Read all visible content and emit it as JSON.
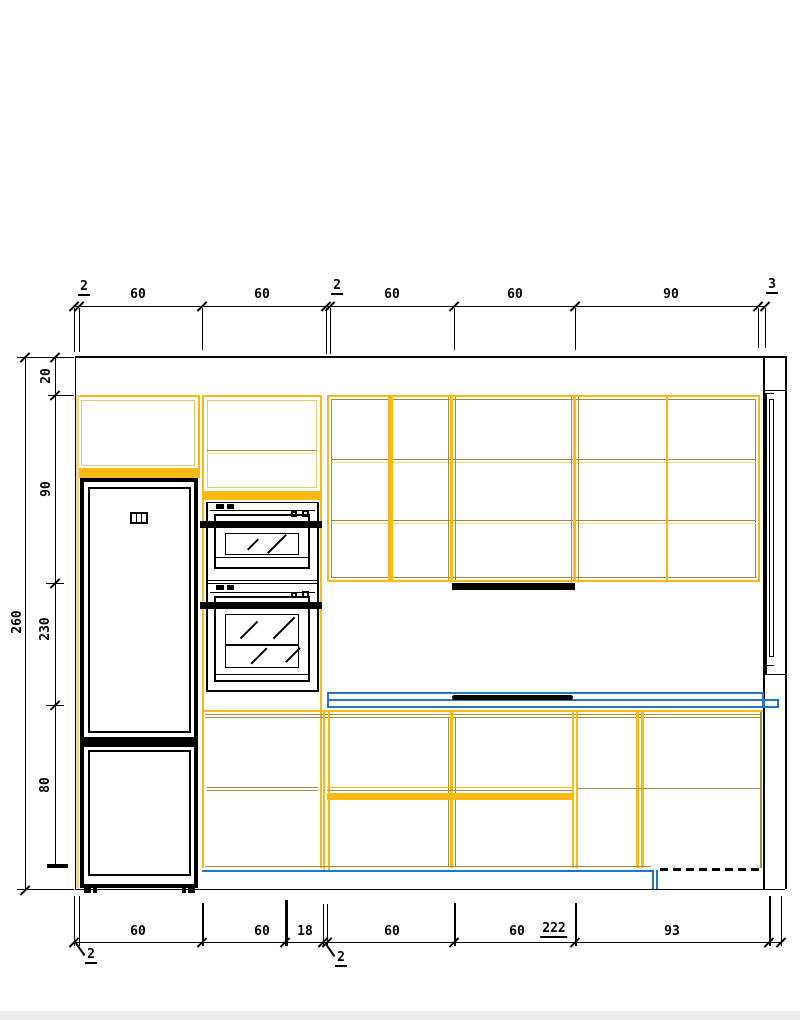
{
  "dims": {
    "top": [
      "2",
      "60",
      "60",
      "2",
      "60",
      "60",
      "90",
      "3"
    ],
    "left": [
      "20",
      "90",
      "230",
      "80"
    ],
    "left_overall": "260",
    "bottom": [
      "60",
      "60",
      "18",
      "60",
      "60",
      "222",
      "93"
    ],
    "leaders": [
      "2",
      "2"
    ]
  },
  "colors": {
    "cabinet_accent": "#FDB913",
    "cabinet_frame": "#A08C3C",
    "countertop": "#2176C7",
    "appliance": "#000000"
  }
}
